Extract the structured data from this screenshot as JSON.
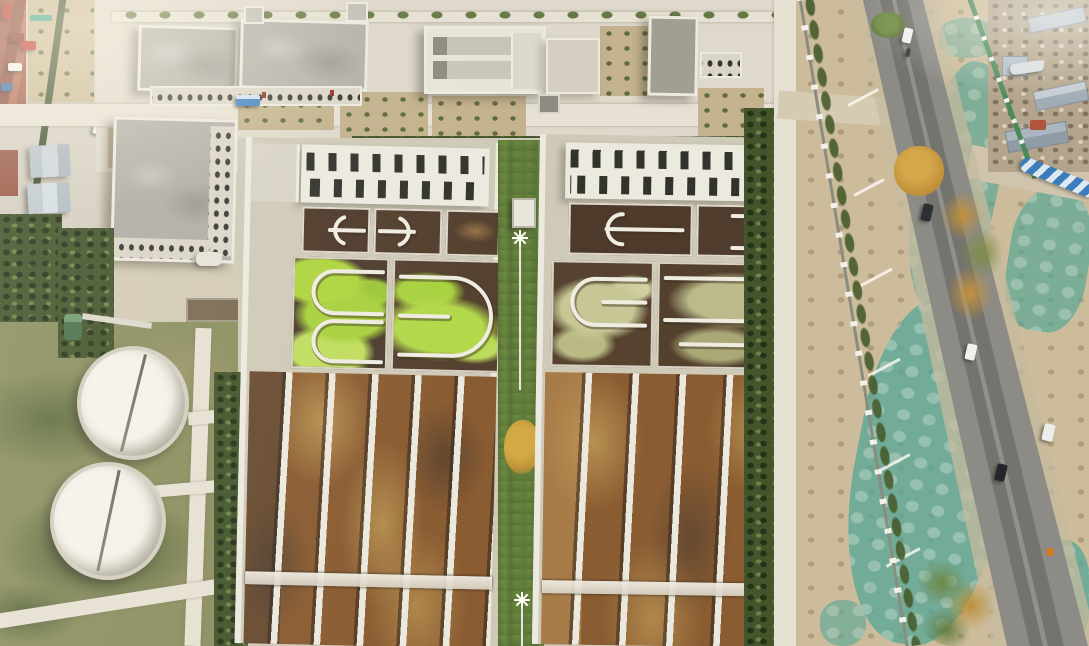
{
  "meta": {
    "title": "Aerial drone photograph of a municipal wastewater treatment plant beside a rural road",
    "image_width": 1089,
    "image_height": 646,
    "visible_text": "none"
  },
  "palette": {
    "ground": "#d3cbb6",
    "pavement": "#dfd9cb",
    "path": "#e7e1d3",
    "concrete": "#cfc9b8",
    "wall-white": "#ece9df",
    "roof-gray": "#b3b0a8",
    "roof-dark": "#a29e94",
    "slot-dark": "#33332e",
    "water-dark": "#4e3a2b",
    "water-rust": "#8a5c32",
    "water-tan": "#bf9a57",
    "algae-green": "#aed43f",
    "algae-olive": "#c6c795",
    "grass": "#8b8f5f",
    "hedge": "#44552c",
    "tree-green": "#5f7a3a",
    "tree-autumn": "#bf9338",
    "dirt": "#c4b28e",
    "net-teal": "#58a696",
    "road": "#8c8b86",
    "road-dark": "#716f6a",
    "fence-green": "#4d8a5a",
    "pipe-blue": "#3d7cba",
    "shed-blue": "#b6c2cc",
    "tank-white": "#f4f2ea",
    "car-red": "#c23b30",
    "car-white": "#f0f1ee",
    "car-dark": "#2c3034",
    "car-blue": "#3f80c2"
  },
  "scene": {
    "labels": {
      "stage": "Aerial view of a wastewater treatment plant, autumn, late-afternoon light",
      "street_west": "Village street with parked cars outside the west wall",
      "container_sheds": "Temporary blue-gray container sheds",
      "admin_building_a": "Administration building (west block)",
      "admin_building_b": "Administration building (east block)",
      "main_building": "Multi-storey office / laboratory building",
      "filter_house": "Filter house with open process channels",
      "blower_house": "Blower house with dark flat roof",
      "clarifier_tank_1": "Covered circular clarifier tank (north)",
      "clarifier_tank_2": "Covered circular clarifier tank (south)",
      "clarifier_field": "Rough grass field around circular tanks",
      "train_left": "Treatment train A: covered tanks, oxidation ditches, sedimentation lanes",
      "train_right": "Treatment train B: covered tanks, oxidation ditches, sedimentation lanes",
      "slotted_roof": "White roof with rows of dark vent slots",
      "oxidation_ditch": "Oxidation ditch cell with white guide baffles",
      "algae_cell": "Ditch cell covered in bright green algae",
      "sedimentation_lanes": "Long parallel sedimentation basins with brown water",
      "median_strip": "Tree-planted median strip between treatment trains",
      "high_mast_light": "High-mast floodlight",
      "east_path": "Concrete patrol path along east fence",
      "boundary_fence": "Plant boundary fence with white posts",
      "dust_net": "Teal dust-suppression netting over bare ground",
      "road": "Two-lane asphalt road running past the plant",
      "road_vehicle": "Vehicle on the road",
      "roadside_trees": "Roadside trees with autumn foliage",
      "junkyard": "Storage / junk yard with light-blue sheds (north-east corner)",
      "blue_pipe": "Blue-and-white striped pipeline",
      "green_tank": "Small green process tank",
      "bus": "Blue shuttle bus parked in the yard"
    },
    "inventory": {
      "circular_clarifiers": 2,
      "treatment_trains": 2,
      "oxidation_ditch_cells_per_train": 5,
      "sedimentation_lanes_train_a": 6,
      "sedimentation_lanes_train_b": 5,
      "high_mast_lights": 2,
      "vehicles_on_road": 6,
      "cars_parked_on_street": 4,
      "container_sheds": 2,
      "junkyard_sheds": 4
    }
  }
}
